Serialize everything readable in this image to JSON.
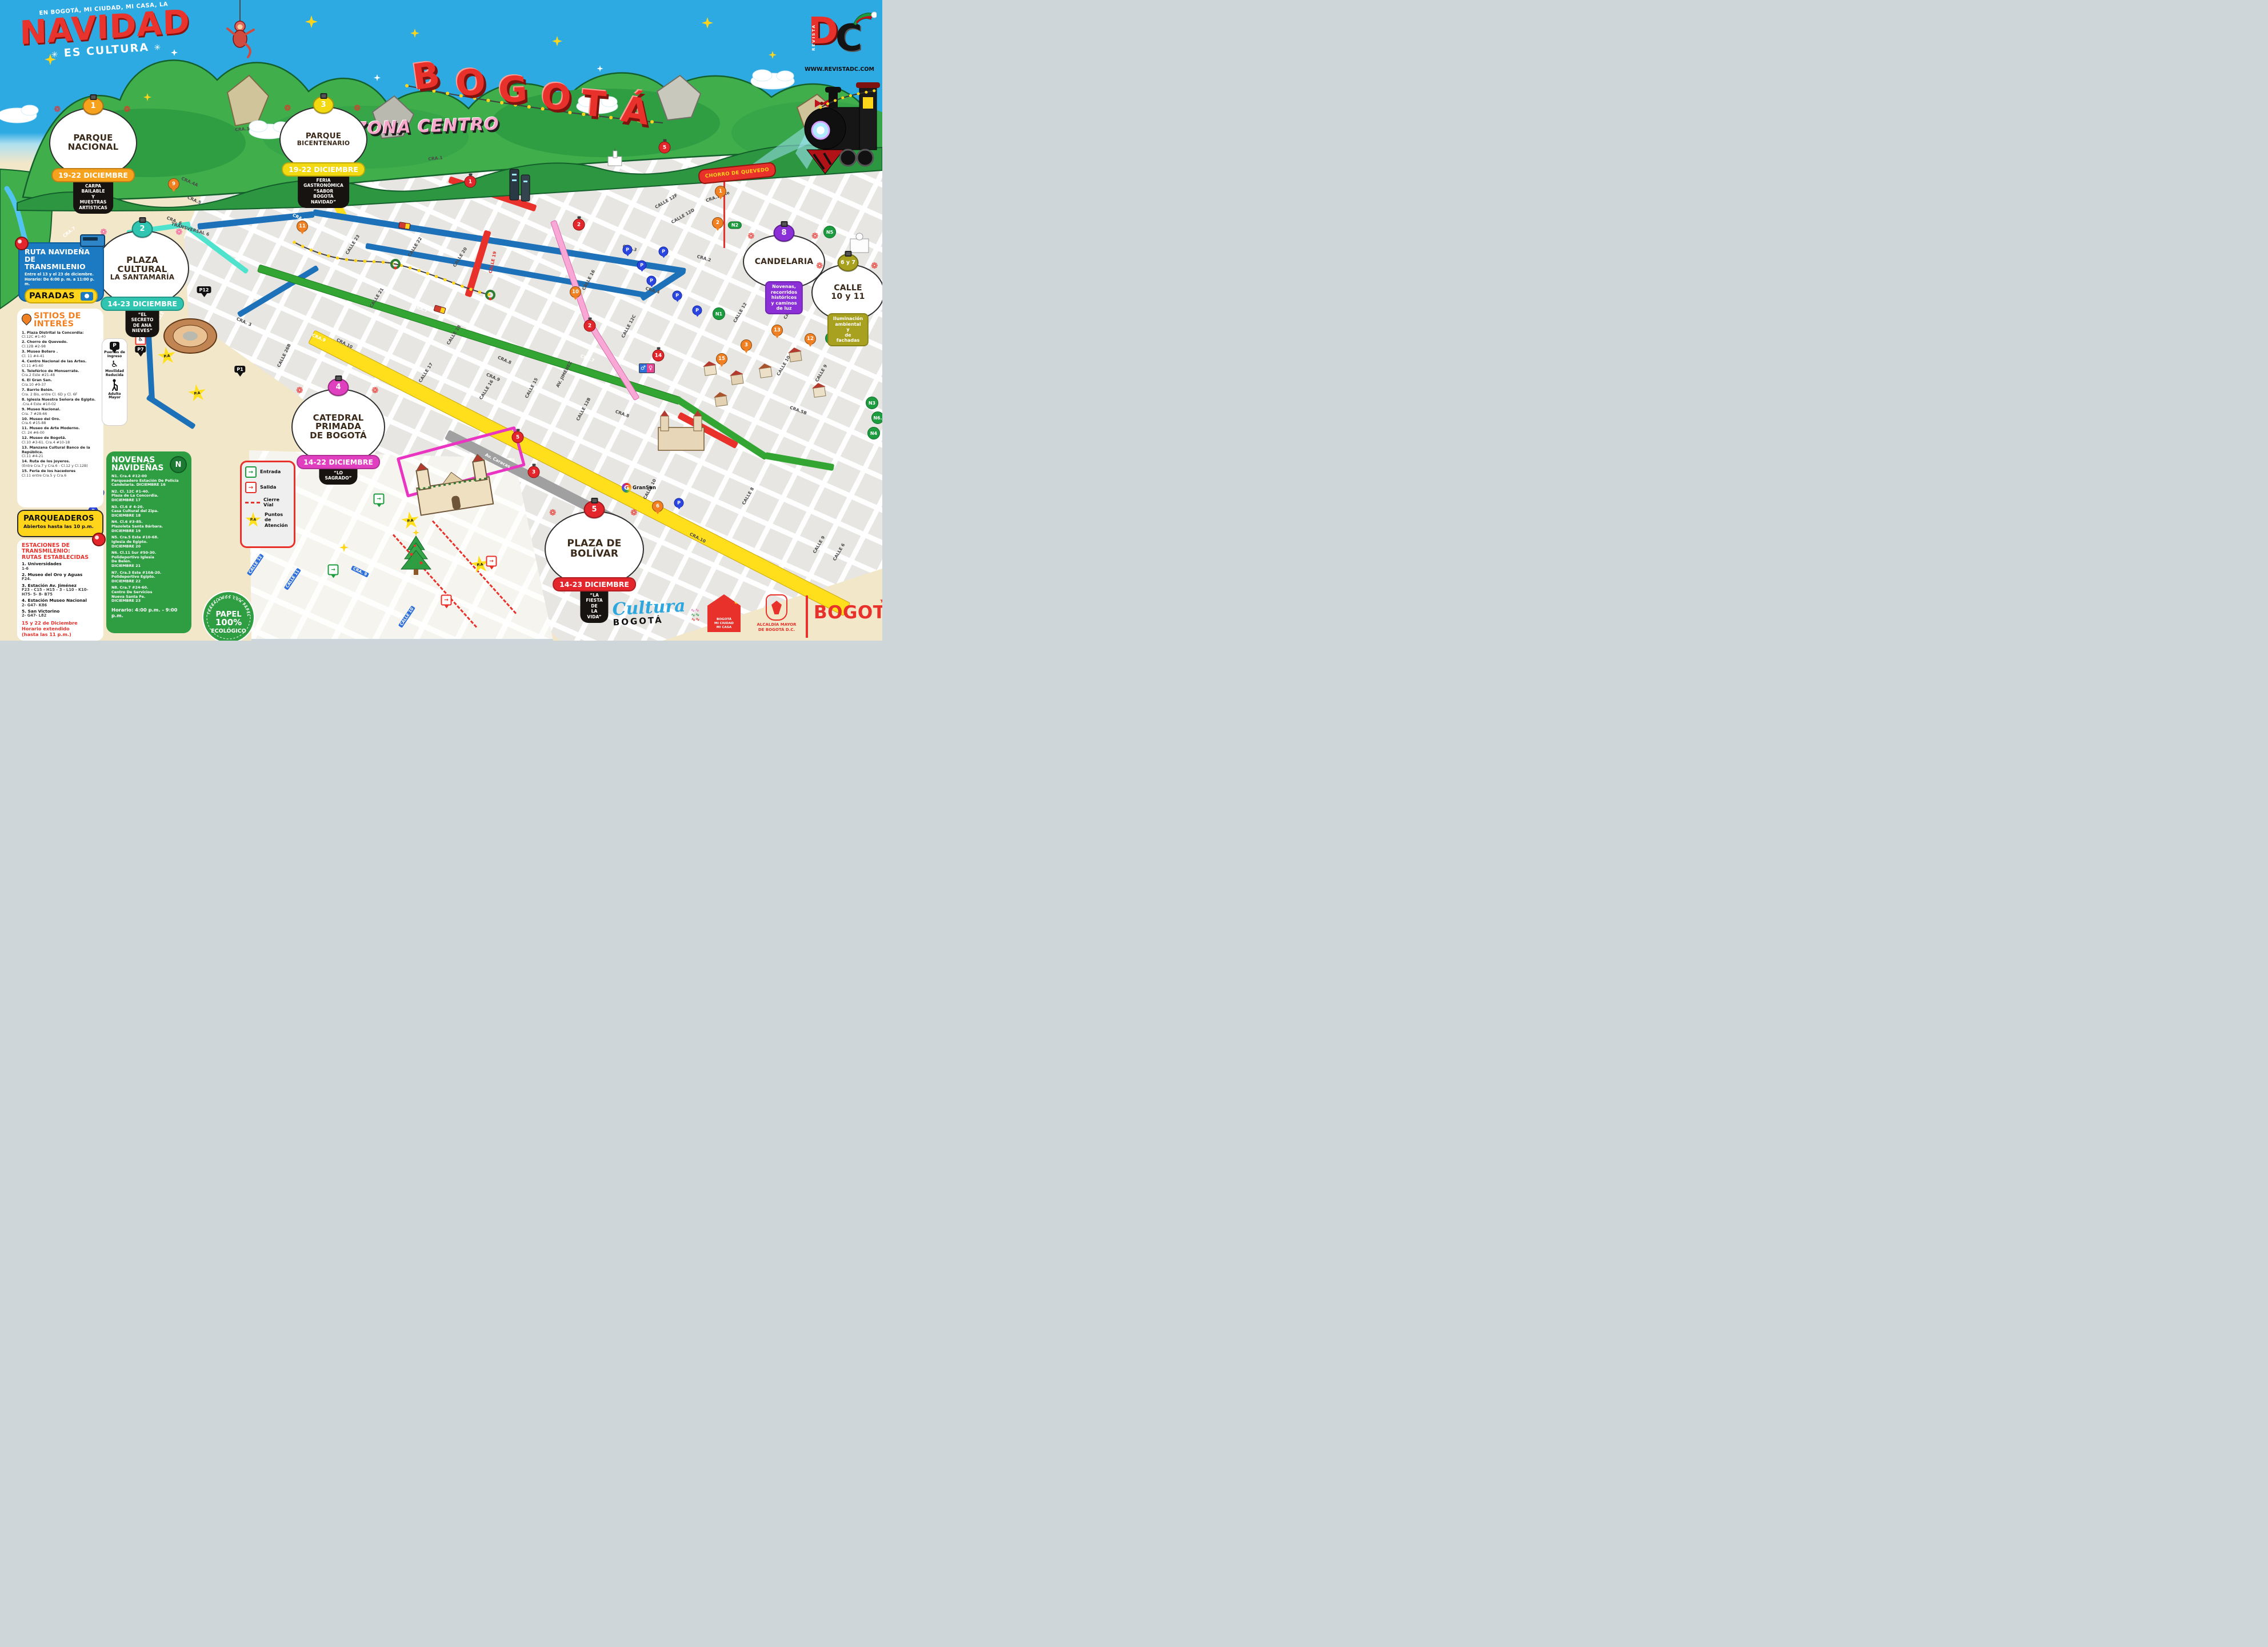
{
  "brand": {
    "tagline": "EN BOGOTÁ, MI CIUDAD, MI CASA, LA",
    "title": "NAVIDAD",
    "subtitle": "ES CULTURA"
  },
  "signs": {
    "bogota_letters": [
      "B",
      "O",
      "G",
      "O",
      "T",
      "Á"
    ],
    "zona": "ZONA CENTRO",
    "chorro": "CHORRO DE QUEVEDO",
    "gransan": "GranSan",
    "papel": {
      "ring": "TRABAJAMOS CON PAPEL RECICLADO",
      "line1": "PAPEL",
      "line2": "100%",
      "line3": "ECOLÓGICO"
    }
  },
  "revista": {
    "vertical": "REVISTA",
    "d": "D",
    "c": "C",
    "url": "WWW.REVISTADC.COM"
  },
  "ruta": {
    "title": "RUTA NAVIDEÑA\nDE TRANSMILENIO",
    "sub": "Entre el 13 y el 23 de diciembre.\nHorario: De 6:00 p. m. a 11:00 p. m.",
    "paradas": "PARADAS"
  },
  "sitios": {
    "title": "SITIOS DE\nINTERÉS",
    "items": [
      {
        "n": "1. Plaza Distrital la Concordia:",
        "a": "Cl.12C #1-40"
      },
      {
        "n": "2. Chorro de Quevedo.",
        "a": "Cl.12B #2-98"
      },
      {
        "n": "3. Museo Botero .",
        "a": "Cl. 11 #4-41"
      },
      {
        "n": "4. Centro Nacional de las Artes.",
        "a": "Cl.11 #5-60"
      },
      {
        "n": "5. Teleférico de Monserrate.",
        "a": "Cra.2 Este #21-48"
      },
      {
        "n": "6. El Gran San.",
        "a": "Cra.10 #9-37"
      },
      {
        "n": "7. Barrio Belén.",
        "a": "Cra. 2 Bis, entre Cl. 6D y Cl. 6F"
      },
      {
        "n": "8.  Iglesia Nuestra Señora de Egipto.",
        "a": ".Cra.4 Este #10-02"
      },
      {
        "n": "9. Museo Nacional.",
        "a": "Cra. 7 #28-66"
      },
      {
        "n": "10. Museo del Oro.",
        "a": "Cra.6 #15-88"
      },
      {
        "n": "11. Museo de Arte Moderno.",
        "a": "Cl. 24 #6-00"
      },
      {
        "n": "12. Museo de Bogotá.",
        "a": "Cl.10 #3-61. Cra.4 #10-18"
      },
      {
        "n": "13. Manzana Cultural Banco de la República.",
        "a": "Cl.11 #4-21"
      },
      {
        "n": "14. Ruta de los joyeros.",
        "a": "(Entre Cra.7 y Cra.6 - Cl.12 y Cl.12B)"
      },
      {
        "n": "15. Feria de los hacedores",
        "a": "Cl.11 entre Cra.5 y Cra.6"
      }
    ]
  },
  "parqueaderos": {
    "title": "PARQUEADEROS",
    "sub": "Abiertos hasta las 10 p.m."
  },
  "estaciones": {
    "title": "ESTACIONES DE\nTRANSMILENIO:\nRUTAS ESTABLECIDAS",
    "items": [
      {
        "n": "1. Universidades",
        "r": "1-6"
      },
      {
        "n": "2. Museo del Oro y Aguas",
        "r": "F24."
      },
      {
        "n": "3. Estación Av. Jiménez",
        "r": "F23 - C15 - H15 – 3 - L10 - K10-\nH75- 5- 8- B75"
      },
      {
        "n": "4. Estación Museo Nacional",
        "r": "2- G47- K86"
      },
      {
        "n": "5. San Victorino",
        "r": "2- G47- L82"
      }
    ],
    "note": "15 y 22 de Diciembre\nHorario extendido\n(hasta las 11 p.m.)"
  },
  "novenas": {
    "title": "NOVENAS\nNAVIDEÑAS",
    "badge": "N",
    "items": [
      "N1. Cra.4 #12-00\nParqueadero Estación De Policía\nCandelaria. DICIEMBRE 16",
      "N2. Cl. 12C #1-40.\nPlaza de La Concordia.\nDICIEMBRE 17",
      "N3. Cl.6 # 4-20.\nCasa Cultural del Zipa.\nDICIEMBRE 18",
      "N4. Cl.6 #3-85.\nPlazoleta Santa Bárbara.\nDICIEMBRE 19",
      "N5. Cra.5 Este #10-68.\nIglesia de Egipto.\nDICIEMBRE 20",
      "N6. Cl.11 Sur #50-30.\nPolideportivo Iglesia\nDe Belén.\nDICIEMBRE 21",
      "N7. Cra.3 Este #10A-20.\nPolideportivo Egipto.\nDICIEMBRE 22",
      "N8. Cra.7 #24-60.\nCentro De Servicios\nNueva Santa Fe.\nDICIEMBRE 23"
    ],
    "horario": "Horario: 4:00 p.m. - 9:00 p.m."
  },
  "legend": {
    "entrada": "Entrada",
    "salida": "Salida",
    "cierre": "Cierre\nVíal",
    "pa_label": "P.A",
    "puntos": "Puntos de\nAtención"
  },
  "accesos": {
    "p": "P",
    "puertas": "Puertas de\nIngreso",
    "movilidad": "Movilidad\nReducida",
    "adulto": "Adulto\nMayor"
  },
  "events": [
    {
      "id": "e1",
      "num": "1",
      "title": [
        "PARQUE",
        "NACIONAL"
      ],
      "date": "19-22 DICIEMBRE",
      "desc": "CARPA BAILABLE\nY MUESTRAS ARTÍSTICAS",
      "color": "#f6a21d"
    },
    {
      "id": "e3",
      "num": "3",
      "title": [
        "PARQUE",
        "BICENTENARIO"
      ],
      "date": "19-22 DICIEMBRE",
      "desc": "FERIA GASTRONÓMICA\n“SABOR BOGOTÁ NAVIDAD”",
      "color": "#f3d912"
    },
    {
      "id": "e2",
      "num": "2",
      "title": [
        "PLAZA",
        "CULTURAL",
        "LA SANTAMARÍA"
      ],
      "date": "14-23 DICIEMBRE",
      "desc": "“EL SECRETO\nDE ANA NIEVES”",
      "color": "#2fc5b1"
    },
    {
      "id": "e4",
      "num": "4",
      "title": [
        "CATEDRAL",
        "PRIMADA",
        "DE BOGOTÁ"
      ],
      "date": "14-22 DICIEMBRE",
      "desc": "“LO SAGRADO”",
      "color": "#e03fc0"
    },
    {
      "id": "e5",
      "num": "5",
      "title": [
        "PLAZA DE",
        "BOLÍVAR"
      ],
      "date": "14-23 DICIEMBRE",
      "desc": "“LA FIESTA DE\nLA VIDA”",
      "color": "#e3262c"
    },
    {
      "id": "e8",
      "num": "8",
      "title": [
        "CANDELARIA"
      ],
      "banner": "Novenas, recorridos\nhistóricos y caminos de luz",
      "color": "#8b2fd6"
    },
    {
      "id": "e67",
      "num": "6 y 7",
      "title": [
        "CALLE",
        "10 y 11"
      ],
      "banner": "Iluminación ambiental y\nde fachadas",
      "color": "#a8a11f"
    }
  ],
  "map": {
    "street_labels": [
      [
        "CRA.1",
        424,
        226,
        -4,
        "dk"
      ],
      [
        "CRA.1",
        762,
        277,
        -6,
        "dk"
      ],
      [
        "CRA.1Este",
        1256,
        344,
        -20,
        "dk"
      ],
      [
        "CRA.4A",
        332,
        318,
        24,
        "dk"
      ],
      [
        "CRA.4B",
        545,
        326,
        24,
        "dk"
      ],
      [
        "CRA.5",
        340,
        350,
        24,
        "dk"
      ],
      [
        "CRA.4",
        538,
        352,
        24,
        "dk"
      ],
      [
        "CRA.5",
        524,
        381,
        24,
        "wh"
      ],
      [
        "CRA. 6",
        305,
        386,
        22,
        "dk"
      ],
      [
        "TRANSVERSAL 6",
        333,
        401,
        16,
        "dk"
      ],
      [
        "CALLE 26B",
        497,
        622,
        -64,
        "dk"
      ],
      [
        "CALLE 27",
        282,
        551,
        -60,
        "wh"
      ],
      [
        "CRA. 3",
        427,
        563,
        24,
        "dk"
      ],
      [
        "CALLE 23",
        617,
        428,
        -58,
        "dk"
      ],
      [
        "CALLE 22",
        726,
        432,
        -58,
        "dk"
      ],
      [
        "CALLE 20",
        805,
        450,
        -58,
        "dk"
      ],
      [
        "CALLE 19",
        862,
        459,
        -78,
        "rd"
      ],
      [
        "CALLE 21",
        659,
        521,
        -58,
        "dk"
      ],
      [
        "CRA.7",
        736,
        540,
        20,
        "wh"
      ],
      [
        "CRA.7",
        1028,
        627,
        20,
        "wh"
      ],
      [
        "CRA.9",
        558,
        591,
        24,
        "wh"
      ],
      [
        "CALLE 18",
        794,
        586,
        -58,
        "dk"
      ],
      [
        "CALLE 17",
        745,
        652,
        -58,
        "dk"
      ],
      [
        "CALLE 16",
        851,
        682,
        -58,
        "dk"
      ],
      [
        "CALLE 16",
        1030,
        490,
        -62,
        "dk"
      ],
      [
        "CALLE 15",
        930,
        679,
        -62,
        "dk"
      ],
      [
        "CRA.9",
        863,
        660,
        24,
        "dk"
      ],
      [
        "CRA.8",
        883,
        630,
        24,
        "dk"
      ],
      [
        "CRA.10",
        603,
        601,
        27,
        "dk"
      ],
      [
        "CRA.10",
        1221,
        941,
        27,
        "dk"
      ],
      [
        "Av. Caracas",
        871,
        806,
        27,
        "wh"
      ],
      [
        "CALLE 12B",
        1021,
        716,
        -62,
        "dk"
      ],
      [
        "CRA.8",
        1089,
        724,
        20,
        "dk"
      ],
      [
        "CALLE 12C",
        1100,
        571,
        -62,
        "dk"
      ],
      [
        "CRA.4",
        1142,
        508,
        16,
        "dk"
      ],
      [
        "CRA.3",
        1102,
        434,
        16,
        "dk"
      ],
      [
        "CRA.2",
        1232,
        452,
        16,
        "dk"
      ],
      [
        "CALLE 12F",
        1166,
        352,
        -30,
        "dk"
      ],
      [
        "CALLE 12D",
        1195,
        378,
        -30,
        "dk"
      ],
      [
        "CALLE 12",
        1295,
        547,
        -60,
        "dk"
      ],
      [
        "CALLE 11",
        1383,
        541,
        -60,
        "dk"
      ],
      [
        "CALLE 10",
        1371,
        640,
        -60,
        "dk"
      ],
      [
        "CALLE 9",
        1437,
        653,
        -60,
        "dk"
      ],
      [
        "CRA.5B",
        1397,
        718,
        20,
        "dk"
      ],
      [
        "CALLE 8",
        1309,
        868,
        -60,
        "dk"
      ],
      [
        "CALLE 9",
        1433,
        953,
        -60,
        "dk"
      ],
      [
        "CALLE 6",
        1468,
        966,
        -60,
        "dk"
      ],
      [
        "CALLE 10",
        1137,
        856,
        -62,
        "dk"
      ],
      [
        "CALLE 12",
        447,
        988,
        -56,
        "bl"
      ],
      [
        "CALLE 11",
        512,
        1013,
        -56,
        "bl"
      ],
      [
        "CALLE 10",
        712,
        1079,
        -56,
        "bl"
      ],
      [
        "CRA. 9",
        630,
        1000,
        26,
        "bl"
      ],
      [
        "CRA.7",
        121,
        406,
        -38,
        "wh"
      ],
      [
        "AV. JIMÉNEZ",
        987,
        655,
        -62,
        "dk"
      ]
    ],
    "orange_pins": [
      [
        "9",
        304,
        322
      ],
      [
        "11",
        529,
        396
      ],
      [
        "10",
        1007,
        511
      ],
      [
        "12",
        1418,
        593
      ],
      [
        "13",
        1360,
        578
      ],
      [
        "15",
        1263,
        628
      ],
      [
        "3",
        1306,
        604
      ],
      [
        "1",
        1261,
        335
      ],
      [
        "2",
        1256,
        390
      ],
      [
        "6",
        1151,
        886
      ]
    ],
    "red_balls": [
      [
        "1",
        823,
        318
      ],
      [
        "2",
        1013,
        393
      ],
      [
        "2",
        1032,
        570
      ],
      [
        "3",
        934,
        826
      ],
      [
        "5",
        906,
        765
      ],
      [
        "5",
        1163,
        258
      ],
      [
        "14",
        1152,
        622
      ]
    ],
    "blue_p_pins": [
      [
        1098,
        437
      ],
      [
        1123,
        464
      ],
      [
        1140,
        491
      ],
      [
        1161,
        440
      ],
      [
        1185,
        517
      ],
      [
        1220,
        543
      ],
      [
        1188,
        880
      ],
      [
        174,
        862
      ],
      [
        163,
        894
      ]
    ],
    "black_pins": [
      [
        "P12",
        357,
        513
      ],
      [
        "P7",
        246,
        617
      ],
      [
        "P1",
        420,
        652
      ]
    ],
    "n_badges": [
      [
        "N1",
        1258,
        549
      ],
      [
        "N5",
        1452,
        406
      ],
      [
        "N7",
        1455,
        592
      ],
      [
        "N3",
        1526,
        705
      ],
      [
        "N6.",
        1536,
        731
      ],
      [
        "N4",
        1529,
        758
      ]
    ],
    "n_pills": [
      [
        "N2",
        1286,
        394
      ]
    ],
    "pa_stars": [
      [
        292,
        623
      ],
      [
        345,
        688
      ],
      [
        718,
        911
      ],
      [
        840,
        988
      ]
    ],
    "entradas": [
      [
        663,
        873
      ],
      [
        583,
        997
      ]
    ],
    "salidas": [
      [
        860,
        982
      ],
      [
        781,
        1050
      ]
    ]
  },
  "footer": {
    "cultura_script": "Cultura",
    "cultura_word": "BOGOTÁ",
    "casa": "BOGOTÁ\nMI CIUDAD\nMI CASA",
    "alcaldia": "ALCALDÍA MAYOR\nDE BOGOTÁ D.C.",
    "bogota": "BOGOTÁ"
  }
}
